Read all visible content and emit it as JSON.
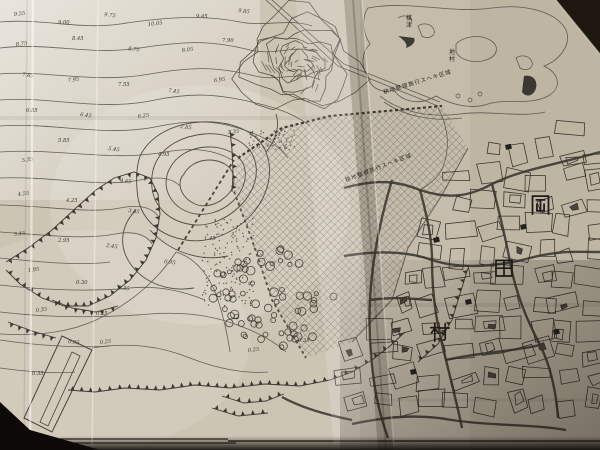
{
  "map": {
    "village_name_chars": [
      {
        "ch": "岡",
        "x": 530,
        "y": 194,
        "size": 21
      },
      {
        "ch": "田",
        "x": 494,
        "y": 258,
        "size": 20
      },
      {
        "ch": "村",
        "x": 430,
        "y": 322,
        "size": 20
      }
    ],
    "place_labels": [
      {
        "text": "楳津",
        "x": 406,
        "y": 20,
        "size": 6,
        "vertical": true
      },
      {
        "text": "地村",
        "x": 449,
        "y": 54,
        "size": 6,
        "vertical": true
      }
    ],
    "annotations": [
      {
        "text": "耕地整理施行スヘキ区域",
        "x": 384,
        "y": 94,
        "rotate": -17,
        "size": 5.5
      },
      {
        "text": "耕地整理施行スヘキ区域",
        "x": 346,
        "y": 182,
        "rotate": -21,
        "size": 5.5
      }
    ],
    "spot_heights": [
      {
        "x": 14,
        "y": 16,
        "v": "9.55"
      },
      {
        "x": 58,
        "y": 24,
        "v": "9.00"
      },
      {
        "x": 104,
        "y": 16,
        "v": "9.75"
      },
      {
        "x": 148,
        "y": 26,
        "v": "10.05"
      },
      {
        "x": 196,
        "y": 18,
        "v": "9.45"
      },
      {
        "x": 238,
        "y": 12,
        "v": "9.85"
      },
      {
        "x": 16,
        "y": 46,
        "v": "8.75"
      },
      {
        "x": 72,
        "y": 40,
        "v": "8.45"
      },
      {
        "x": 128,
        "y": 50,
        "v": "8.75"
      },
      {
        "x": 182,
        "y": 52,
        "v": "8.05"
      },
      {
        "x": 222,
        "y": 42,
        "v": "7.90"
      },
      {
        "x": 22,
        "y": 76,
        "v": "7.85"
      },
      {
        "x": 68,
        "y": 82,
        "v": "7.95"
      },
      {
        "x": 118,
        "y": 86,
        "v": "7.55"
      },
      {
        "x": 168,
        "y": 92,
        "v": "7.45"
      },
      {
        "x": 214,
        "y": 82,
        "v": "6.95"
      },
      {
        "x": 26,
        "y": 112,
        "v": "6.85"
      },
      {
        "x": 80,
        "y": 116,
        "v": "6.45"
      },
      {
        "x": 138,
        "y": 118,
        "v": "6.25"
      },
      {
        "x": 58,
        "y": 142,
        "v": "5.85"
      },
      {
        "x": 108,
        "y": 150,
        "v": "5.45"
      },
      {
        "x": 22,
        "y": 162,
        "v": "5.35"
      },
      {
        "x": 158,
        "y": 156,
        "v": "4.95"
      },
      {
        "x": 120,
        "y": 182,
        "v": "4.65"
      },
      {
        "x": 18,
        "y": 196,
        "v": "4.55"
      },
      {
        "x": 66,
        "y": 202,
        "v": "4.25"
      },
      {
        "x": 128,
        "y": 212,
        "v": "3.85"
      },
      {
        "x": 14,
        "y": 236,
        "v": "3.45"
      },
      {
        "x": 58,
        "y": 242,
        "v": "2.95"
      },
      {
        "x": 106,
        "y": 247,
        "v": "2.45"
      },
      {
        "x": 28,
        "y": 272,
        "v": "1.95"
      },
      {
        "x": 76,
        "y": 284,
        "v": "0.30"
      },
      {
        "x": 118,
        "y": 289,
        "v": "0.35"
      },
      {
        "x": 36,
        "y": 312,
        "v": "0.35"
      },
      {
        "x": 96,
        "y": 315,
        "v": "0.25"
      },
      {
        "x": 68,
        "y": 343,
        "v": "0.05"
      },
      {
        "x": 100,
        "y": 344,
        "v": "0.25"
      },
      {
        "x": 32,
        "y": 375,
        "v": "0.35"
      },
      {
        "x": 180,
        "y": 128,
        "v": "2.85"
      },
      {
        "x": 228,
        "y": 134,
        "v": "2.35"
      },
      {
        "x": 204,
        "y": 240,
        "v": "1.45"
      },
      {
        "x": 164,
        "y": 263,
        "v": "0.95"
      },
      {
        "x": 248,
        "y": 352,
        "v": "0.25"
      },
      {
        "x": 298,
        "y": 342,
        "v": "0.35"
      }
    ],
    "colors": {
      "paper_light": "#e6dfd2",
      "paper_mid": "#cdc5b4",
      "paper_tan": "#c0b4a0",
      "ink": "#45423a",
      "ink_dark": "#24221d",
      "photo_background": "#1d1710",
      "shadow": "#0f0b07"
    }
  }
}
